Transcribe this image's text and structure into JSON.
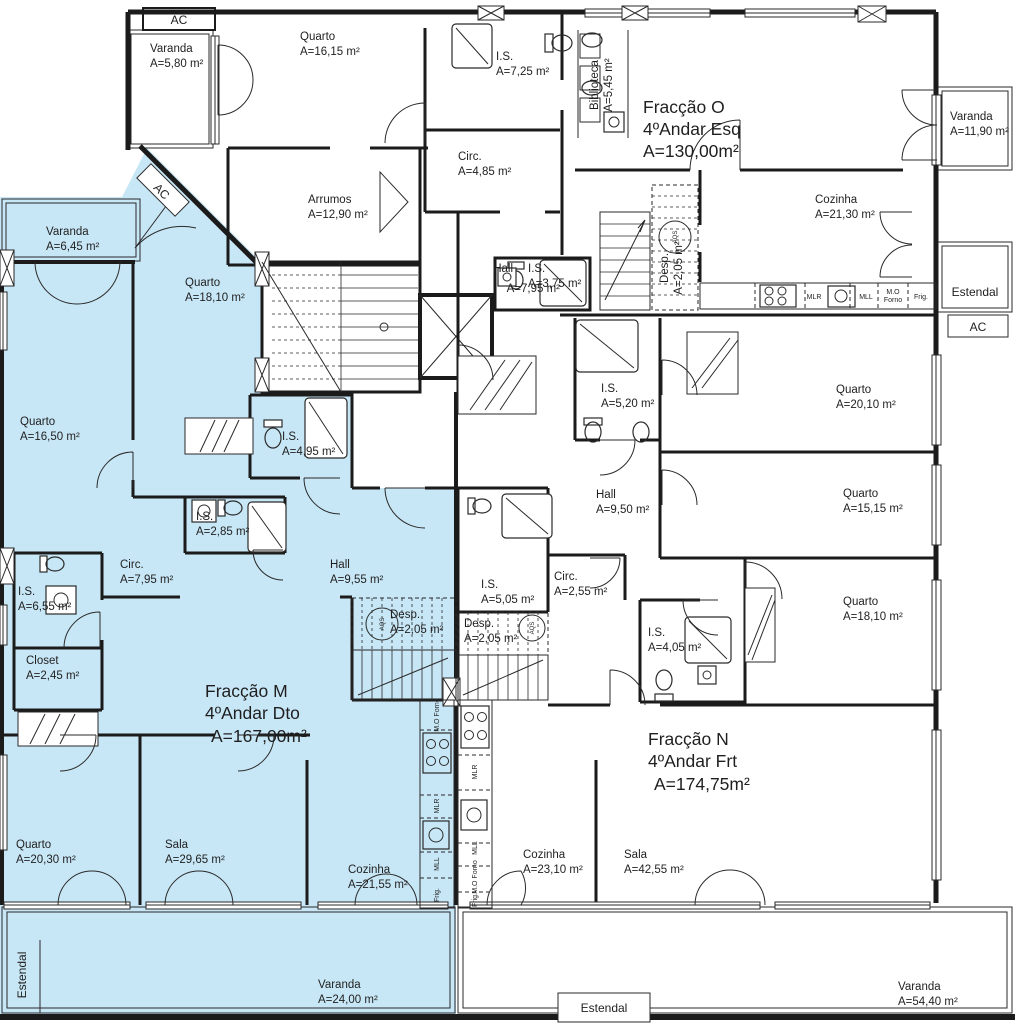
{
  "drawing": {
    "type": "floor-plan",
    "fractions": [
      {
        "title": "Fracção M",
        "floor": "4ºAndar Dto",
        "area": "A=167,00m²"
      },
      {
        "title": "Fracção N",
        "floor": "4ºAndar Frt",
        "area": "A=174,75m²"
      },
      {
        "title": "Fracção O",
        "floor": "4ºAndar Esq",
        "area": "A=130,00m²"
      }
    ]
  },
  "rooms": {
    "o_varanda": {
      "name": "Varanda",
      "area": "A=5,80 m²"
    },
    "o_quarto1": {
      "name": "Quarto",
      "area": "A=16,15 m²"
    },
    "o_is1": {
      "name": "I.S.",
      "area": "A=7,25 m²"
    },
    "o_biblioteca": {
      "name": "Biblioteca",
      "area": "A=5,45 m²"
    },
    "o_circ": {
      "name": "Circ.",
      "area": "A=4,85 m²"
    },
    "o_arrumos": {
      "name": "Arrumos",
      "area": "A=12,90 m²"
    },
    "o_is2": {
      "name": "I.S.",
      "area": "A=3,75 m²"
    },
    "o_hall": {
      "name": "Hall",
      "area": "A=7,95 m²"
    },
    "o_cozinha": {
      "name": "Cozinha",
      "area": "A=21,30 m²"
    },
    "o_desp": {
      "name": "Desp.",
      "area": "A=2,05 m²"
    },
    "o_varanda2": {
      "name": "Varanda",
      "area": "A=11,90 m²"
    },
    "n_is1": {
      "name": "I.S.",
      "area": "A=5,20 m²"
    },
    "n_quarto1": {
      "name": "Quarto",
      "area": "A=20,10 m²"
    },
    "n_quarto2": {
      "name": "Quarto",
      "area": "A=15,15 m²"
    },
    "n_hall": {
      "name": "Hall",
      "area": "A=9,50 m²"
    },
    "n_quarto3": {
      "name": "Quarto",
      "area": "A=18,10 m²"
    },
    "n_is2": {
      "name": "I.S.",
      "area": "A=4,05 m²"
    },
    "n_circ": {
      "name": "Circ.",
      "area": "A=2,55 m²"
    },
    "n_is3": {
      "name": "I.S.",
      "area": "A=5,05 m²"
    },
    "n_desp": {
      "name": "Desp.",
      "area": "A=2,05 m²"
    },
    "n_cozinha": {
      "name": "Cozinha",
      "area": "A=23,10 m²"
    },
    "n_sala": {
      "name": "Sala",
      "area": "A=42,55 m²"
    },
    "n_varanda": {
      "name": "Varanda",
      "area": "A=54,40 m²"
    },
    "m_varanda1": {
      "name": "Varanda",
      "area": "A=6,45 m²"
    },
    "m_quarto1": {
      "name": "Quarto",
      "area": "A=18,10 m²"
    },
    "m_quarto2": {
      "name": "Quarto",
      "area": "A=16,50 m²"
    },
    "m_is1": {
      "name": "I.S.",
      "area": "A=4,95 m²"
    },
    "m_is2": {
      "name": "I.S.",
      "area": "A=2,85 m²"
    },
    "m_circ": {
      "name": "Circ.",
      "area": "A=7,95 m²"
    },
    "m_hall": {
      "name": "Hall",
      "area": "A=9,55 m²"
    },
    "m_is3": {
      "name": "I.S.",
      "area": "A=6,55 m²"
    },
    "m_closet": {
      "name": "Closet",
      "area": "A=2,45 m²"
    },
    "m_desp": {
      "name": "Desp.",
      "area": "A=2,05 m²"
    },
    "m_quarto3": {
      "name": "Quarto",
      "area": "A=20,30 m²"
    },
    "m_sala": {
      "name": "Sala",
      "area": "A=29,65 m²"
    },
    "m_cozinha": {
      "name": "Cozinha",
      "area": "A=21,55 m²"
    },
    "m_varanda2": {
      "name": "Varanda",
      "area": "A=24,00 m²"
    }
  },
  "labels": {
    "ac": "AC",
    "estendal": "Estendal"
  },
  "appliances": {
    "mlr": "MLR",
    "mll": "MLL",
    "mo": "M.O",
    "forno": "Forno",
    "mo_forno": "M.O Forno",
    "frig": "Frig.",
    "aqs": "AQS"
  },
  "colors": {
    "fraccao_m_fill": "#c8e7f6",
    "wall": "#1b1b1b",
    "background": "#ffffff"
  }
}
